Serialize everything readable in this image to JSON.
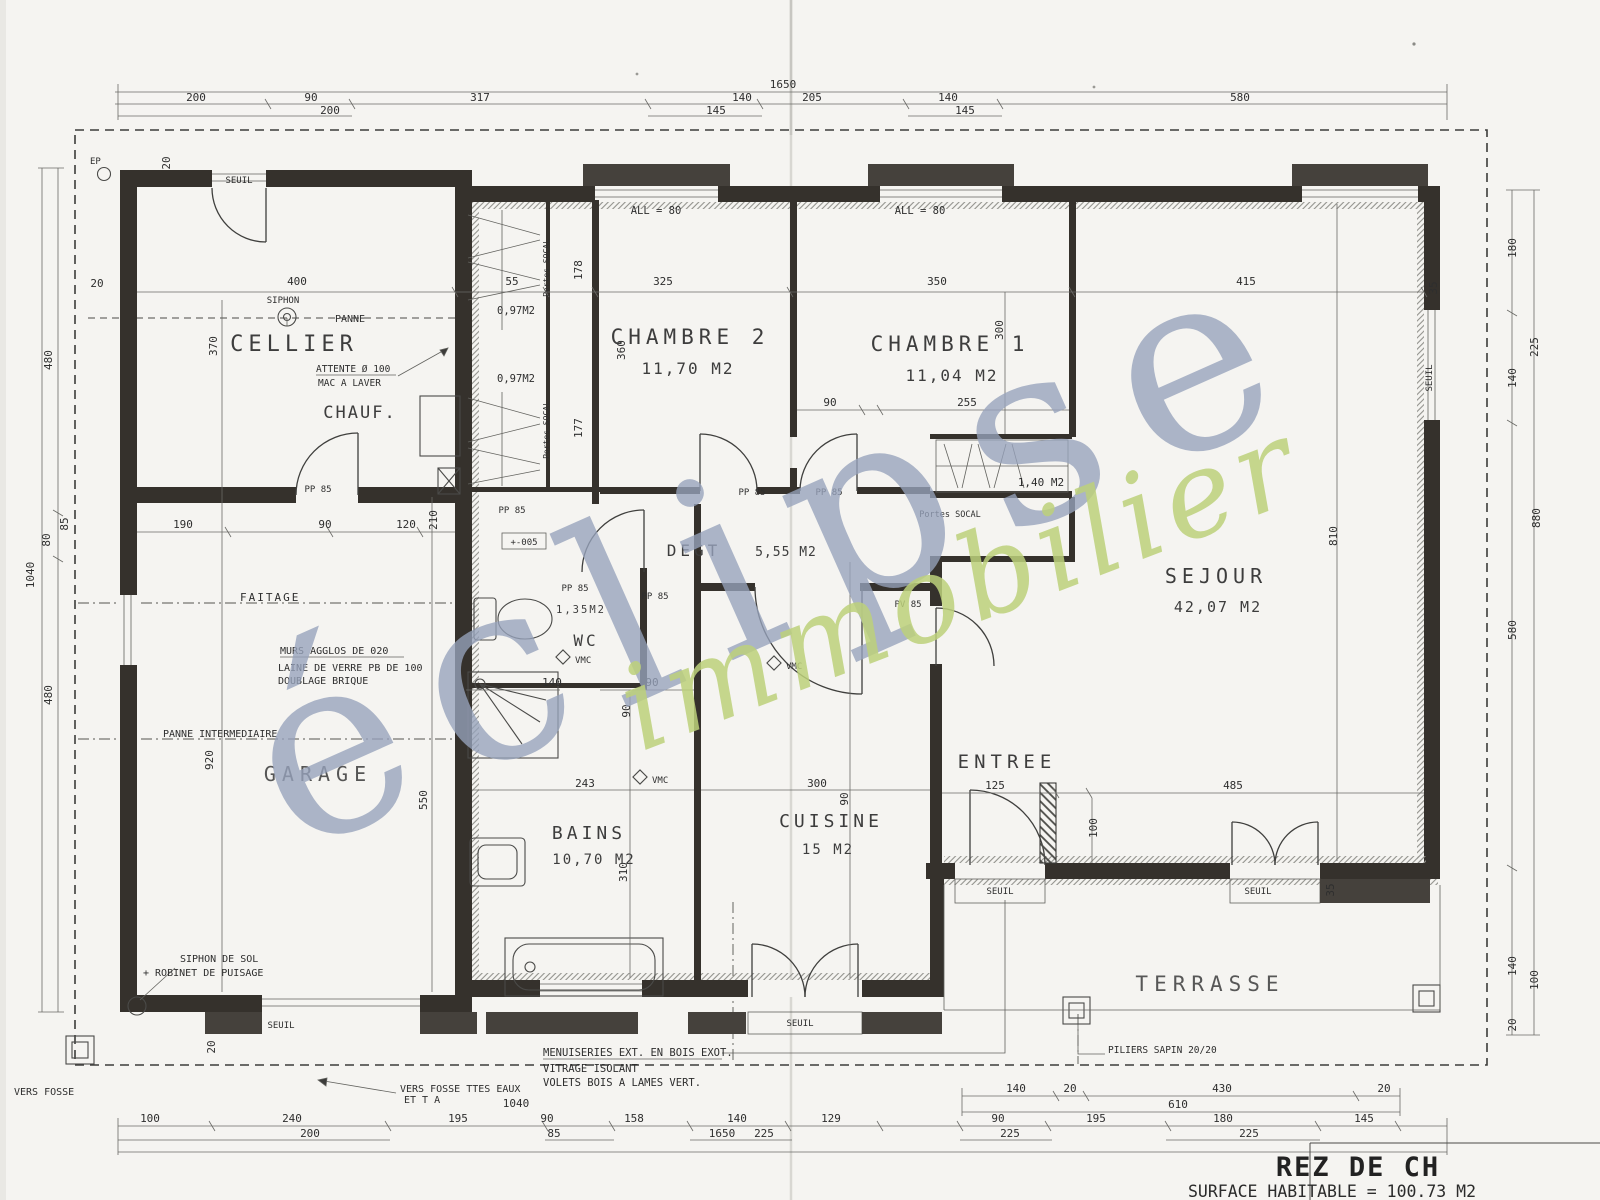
{
  "title_block": {
    "floor": "REZ DE CH",
    "surface": "SURFACE HABITABLE = 100.73 M2"
  },
  "watermark": {
    "word1": "éclipse",
    "word2": "immobilier",
    "color1": "#97a3bc",
    "color2": "#bdd17b"
  },
  "rooms": {
    "cellier": {
      "name": "CELLIER"
    },
    "chauf": {
      "name": "CHAUF."
    },
    "chambre2": {
      "name": "CHAMBRE 2",
      "area": "11,70 M2"
    },
    "chambre1": {
      "name": "CHAMBRE 1",
      "area": "11,04 M2"
    },
    "sejour": {
      "name": "SEJOUR",
      "area": "42,07 M2"
    },
    "degagement": {
      "name": "DEGT",
      "area": "5,55 M2"
    },
    "wc": {
      "name": "WC",
      "area": "1,35M2"
    },
    "bains": {
      "name": "BAINS",
      "area": "10,70 M2"
    },
    "cuisine": {
      "name": "CUISINE",
      "area": "15 M2"
    },
    "garage": {
      "name": "GARAGE"
    },
    "entree": {
      "name": "ENTREE"
    },
    "terrasse": {
      "name": "TERRASSE"
    }
  },
  "labels": {
    "ep": "EP",
    "seuil": "SEUIL",
    "allege": "ALL = 80",
    "pp85": "PP 85",
    "pv85": "PV 85",
    "vmc": "VMC",
    "siphon": "SIPHON",
    "panne": "PANNE",
    "attente": "ATTENTE Ø 100",
    "mac_a_laver": "MAC A LAVER",
    "faitage": "FAITAGE",
    "murs": "MURS AGGLOS DE 020",
    "laine": "LAINE DE VERRE PB DE 100",
    "doublage": "DOUBLAGE BRIQUE",
    "panne_intermediaire": "PANNE INTERMEDIAIRE",
    "siphon_de_sol": "SIPHON DE SOL",
    "robinet": "+ ROBINET DE PUISAGE",
    "portes_socal": "Portes SOCAL",
    "placard_petit": "0,97M2",
    "placard_grand": "1,40 M2",
    "note_menuiseries": "MENUISERIES EXT. EN BOIS EXOT.",
    "note_vitrage": "VITRAGE ISOLANT",
    "note_volets": "VOLETS BOIS A LAMES VERT.",
    "vers_fosse_1": "VERS FOSSE TTES EAUX",
    "vers_fosse_2": "ET T A",
    "vers_fosse_gauche": "VERS FOSSE",
    "piliers": "PILIERS SAPIN 20/20",
    "niveau": "+-005"
  },
  "dims": {
    "top_total": "1650",
    "top_row1": [
      "200",
      "90",
      "317",
      "140",
      "205",
      "140",
      "580"
    ],
    "top_row2": [
      "200",
      "145",
      "145"
    ],
    "bottom_row1": [
      "100",
      "240",
      "195",
      "90",
      "158",
      "140",
      "129",
      "90",
      "195",
      "180",
      "145"
    ],
    "bottom_row2": [
      "200",
      "85",
      "1650",
      "225",
      "225",
      "225"
    ],
    "bottom_row3": [
      "140",
      "20",
      "430",
      "20"
    ],
    "bottom_total": "610",
    "bottom_note": "1040",
    "left_col": [
      "480",
      "85",
      "80",
      "480",
      "1040"
    ],
    "right_col": [
      "180",
      "225",
      "140",
      "880",
      "580",
      "140",
      "100",
      "20"
    ],
    "inner": {
      "mur20_haut": "20",
      "mur20_gauche": "20",
      "cellier_400": "400",
      "cellier_370": "370",
      "cellier_190": "190",
      "cellier_90": "90",
      "cellier_120": "120",
      "cellier_210": "210",
      "placard_55": "55",
      "placard_178": "178",
      "placard_177": "177",
      "chambre2_325": "325",
      "chambre2_360": "360",
      "chambre1_350": "350",
      "chambre1_90": "90",
      "chambre1_255": "255",
      "chambre1_300": "300",
      "sejour_415": "415",
      "sejour_35": "35",
      "sejour_810": "810",
      "entree_125": "125",
      "entree_485": "485",
      "entree_100": "100",
      "cuisine_300": "300",
      "cuisine_90": "90",
      "bains_140": "140",
      "bains_90a": "90",
      "bains_90b": "90",
      "bains_243": "243",
      "bains_310": "310",
      "garage_920": "920",
      "garage_550": "550",
      "garage_20": "20",
      "terrasse_35": "35"
    }
  }
}
